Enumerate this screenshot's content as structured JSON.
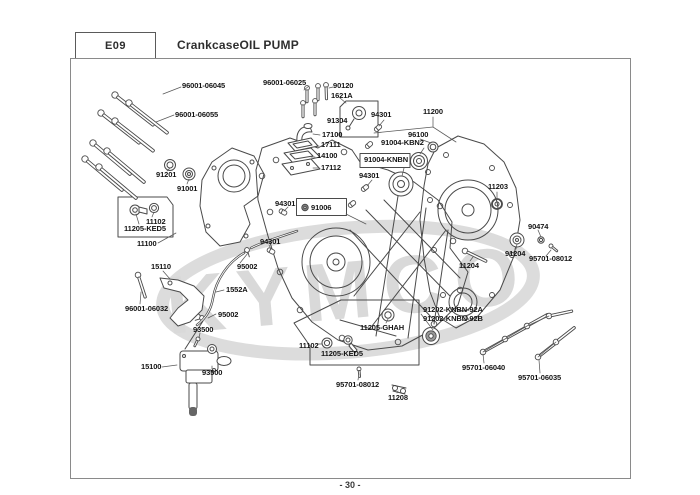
{
  "header": {
    "section_code": "E09",
    "title": "CrankcaseOIL PUMP"
  },
  "footer": {
    "page_number": "- 30 -"
  },
  "watermark": {
    "text": "KYMCO"
  },
  "diagram": {
    "part_labels": [
      {
        "text": "96001-06045"
      },
      {
        "text": "96001-06055"
      },
      {
        "text": "96001-06025"
      },
      {
        "text": "90120"
      },
      {
        "text": "1621A"
      },
      {
        "text": "91304"
      },
      {
        "text": "17100"
      },
      {
        "text": "17111"
      },
      {
        "text": "14100"
      },
      {
        "text": "17112"
      },
      {
        "text": "94301"
      },
      {
        "text": "11200"
      },
      {
        "text": "96100"
      },
      {
        "text": "91004-KBN2"
      },
      {
        "text": "91004-KNBN"
      },
      {
        "text": "94301"
      },
      {
        "text": "11203"
      },
      {
        "text": "91201"
      },
      {
        "text": "91001"
      },
      {
        "text": "94301"
      },
      {
        "text": "91006"
      },
      {
        "text": "94301"
      },
      {
        "text": "95002"
      },
      {
        "text": "11102"
      },
      {
        "text": "11205-KED5"
      },
      {
        "text": "11100"
      },
      {
        "text": "15110"
      },
      {
        "text": "1552A"
      },
      {
        "text": "96001-06032"
      },
      {
        "text": "95002"
      },
      {
        "text": "93500"
      },
      {
        "text": "15100"
      },
      {
        "text": "93500"
      },
      {
        "text": "90474"
      },
      {
        "text": "91204"
      },
      {
        "text": "95701-08012"
      },
      {
        "text": "11204"
      },
      {
        "text": "11205-GHAH"
      },
      {
        "text": "91202-KNBN-92A"
      },
      {
        "text": "91202-KNBN-92B"
      },
      {
        "text": "11102"
      },
      {
        "text": "11205-KED5"
      },
      {
        "text": "95701-08012"
      },
      {
        "text": "11208"
      },
      {
        "text": "95701-06040"
      },
      {
        "text": "95701-06035"
      }
    ]
  }
}
